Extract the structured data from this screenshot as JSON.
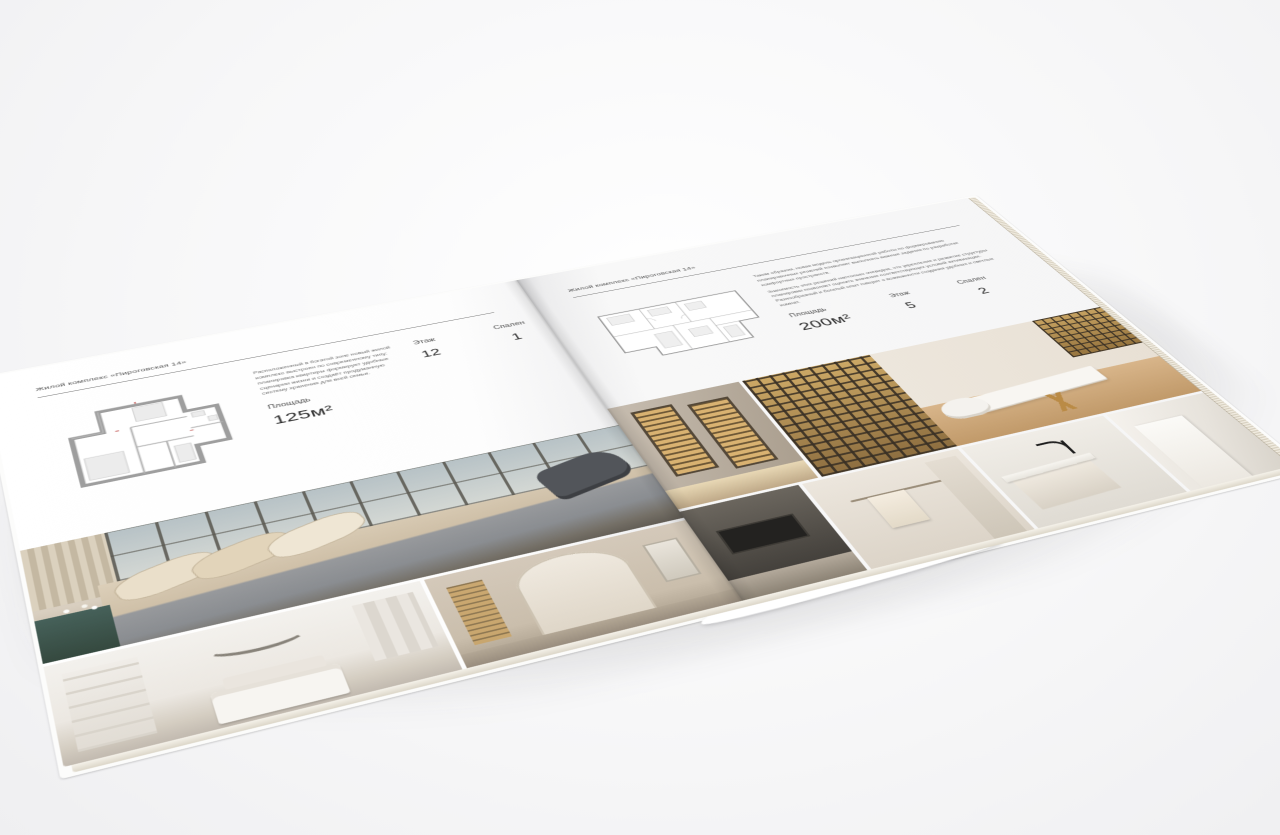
{
  "scene": {
    "background_color": "#f7f7f8",
    "page_color": "#fcfcfc",
    "shadow_color": "#23232a"
  },
  "brochure": {
    "header_title": "Жилой комплекс «Пироговская 14»",
    "left_page": {
      "description": "Расположенный в богатой зоне новый жилой комплекс выстроен по современному типу: планировка квартиры формирует удобные сценарии жизни и создаёт продуманную систему хранения для всей семьи.",
      "area_label": "Площадь",
      "area_value": "125м²",
      "specs": [
        {
          "label": "Этаж",
          "value": "12"
        },
        {
          "label": "Спален",
          "value": "1"
        }
      ],
      "floor_plan": {
        "name": "plan-125",
        "wall_color": "#9e9e9e"
      },
      "photos": [
        {
          "name": "bedroom-suite",
          "palette": [
            "#cfc8bd",
            "#8a8d91",
            "#52555a",
            "#46615a"
          ]
        },
        {
          "name": "white-bedroom",
          "palette": [
            "#f3f1ed",
            "#88837a"
          ]
        },
        {
          "name": "hallway-arch",
          "palette": [
            "#d4c9ba",
            "#c9a468"
          ]
        }
      ]
    },
    "right_page": {
      "description_1": "Таким образом, новая модель организационной работы по формированию планировочных решений позволяет выполнять важные задания по разработке комфортных пространств.",
      "description_2": "Значимость этих решений настолько очевидна, что укрепление и развитие структуры планировки позволяет оценить значение соответствующих условий активизации. Разнообразный и богатый опыт говорит о возможности создания удобных и светлых комнат.",
      "area_label": "Площадь",
      "area_value": "200м²",
      "specs": [
        {
          "label": "Этаж",
          "value": "5"
        },
        {
          "label": "Спален",
          "value": "2"
        }
      ],
      "floor_plan": {
        "name": "plan-200",
        "wall_color": "#8f8f8f"
      },
      "photos": [
        {
          "name": "wardrobe-hall",
          "palette": [
            "#a99d8d",
            "#d9b271"
          ]
        },
        {
          "name": "display-cabinets-desk",
          "palette": [
            "#cda966",
            "#d8b58a",
            "#f8f6f2"
          ]
        },
        {
          "name": "dark-kitchen",
          "palette": [
            "#3a3733",
            "#232220"
          ]
        },
        {
          "name": "bathroom",
          "palette": [
            "#ece6dd",
            "#f4ecdf"
          ]
        },
        {
          "name": "kitchen-island",
          "palette": [
            "#f0ede7",
            "#1d1d1d"
          ]
        },
        {
          "name": "counter-detail",
          "palette": [
            "#f5f2ed"
          ]
        }
      ]
    }
  }
}
